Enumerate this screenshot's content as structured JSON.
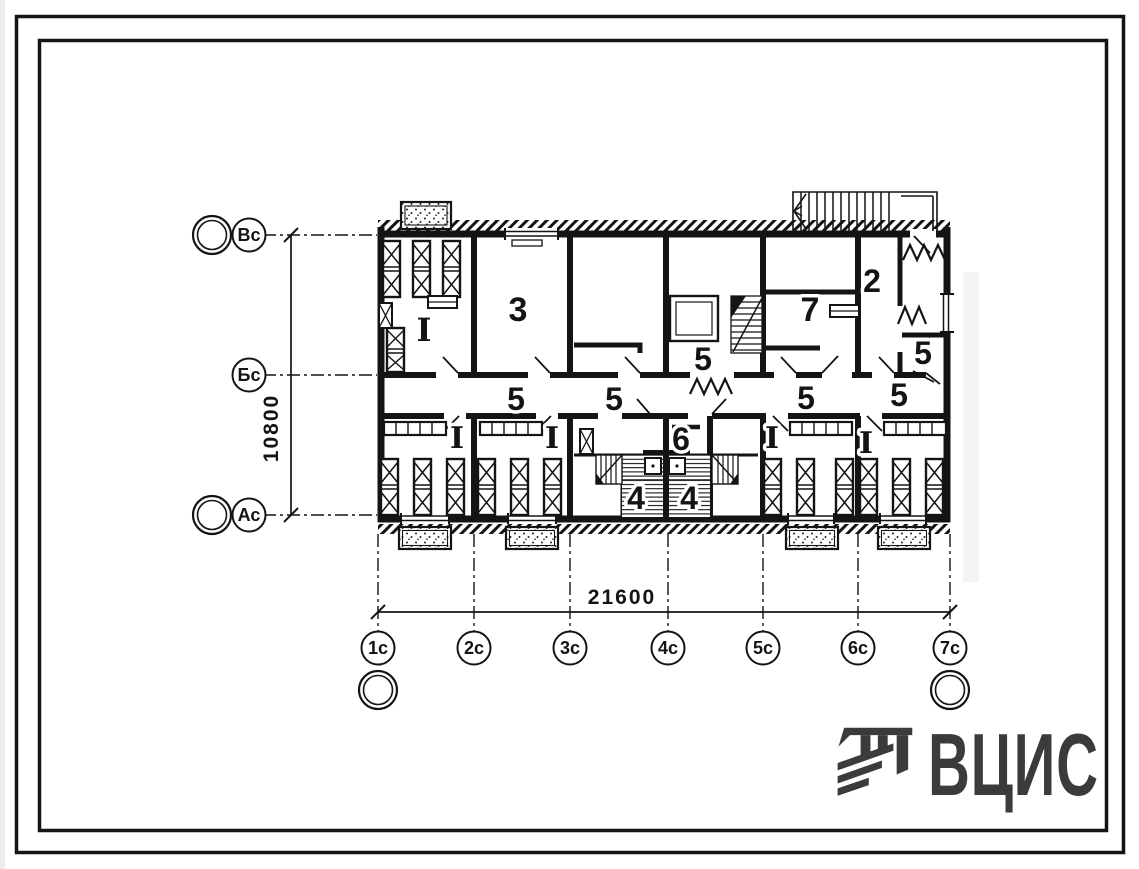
{
  "plan": {
    "dim_horizontal": "21600",
    "dim_vertical": "10800",
    "room_labels": [
      {
        "text": "I",
        "x": 424,
        "y": 341,
        "size": 32,
        "font": "serif"
      },
      {
        "text": "3",
        "x": 518,
        "y": 321,
        "size": 34,
        "font": "sans"
      },
      {
        "text": "5",
        "x": 703,
        "y": 370,
        "size": 32,
        "font": "sans"
      },
      {
        "text": "7",
        "x": 810,
        "y": 321,
        "size": 34,
        "font": "sans"
      },
      {
        "text": "2",
        "x": 872,
        "y": 292,
        "size": 32,
        "font": "sans"
      },
      {
        "text": "5",
        "x": 923,
        "y": 364,
        "size": 32,
        "font": "sans"
      },
      {
        "text": "5",
        "x": 516,
        "y": 410,
        "size": 32,
        "font": "sans"
      },
      {
        "text": "5",
        "x": 614,
        "y": 410,
        "size": 32,
        "font": "sans"
      },
      {
        "text": "5",
        "x": 806,
        "y": 409,
        "size": 32,
        "font": "sans"
      },
      {
        "text": "5",
        "x": 899,
        "y": 406,
        "size": 32,
        "font": "sans"
      },
      {
        "text": "I",
        "x": 457,
        "y": 448,
        "size": 30,
        "font": "serif"
      },
      {
        "text": "I",
        "x": 552,
        "y": 448,
        "size": 30,
        "font": "serif"
      },
      {
        "text": "6",
        "x": 681,
        "y": 450,
        "size": 32,
        "font": "sans"
      },
      {
        "text": "I",
        "x": 772,
        "y": 448,
        "size": 30,
        "font": "serif"
      },
      {
        "text": "I",
        "x": 866,
        "y": 453,
        "size": 30,
        "font": "serif"
      },
      {
        "text": "4",
        "x": 636,
        "y": 509,
        "size": 32,
        "font": "sans"
      },
      {
        "text": "4",
        "x": 689,
        "y": 509,
        "size": 32,
        "font": "sans"
      }
    ],
    "grid_bottom": [
      {
        "label": "1с",
        "x": 378
      },
      {
        "label": "2с",
        "x": 474
      },
      {
        "label": "3с",
        "x": 570
      },
      {
        "label": "4с",
        "x": 668
      },
      {
        "label": "5с",
        "x": 763
      },
      {
        "label": "6с",
        "x": 858
      },
      {
        "label": "7с",
        "x": 950
      }
    ],
    "grid_left": [
      {
        "label": "Вс",
        "y": 235
      },
      {
        "label": "Бс",
        "y": 375
      },
      {
        "label": "Ас",
        "y": 515
      }
    ]
  },
  "logo": {
    "text": "ВЦИС"
  },
  "colors": {
    "ink": "#141414",
    "logo": "#3b3b3d",
    "paper": "#ffffff"
  }
}
